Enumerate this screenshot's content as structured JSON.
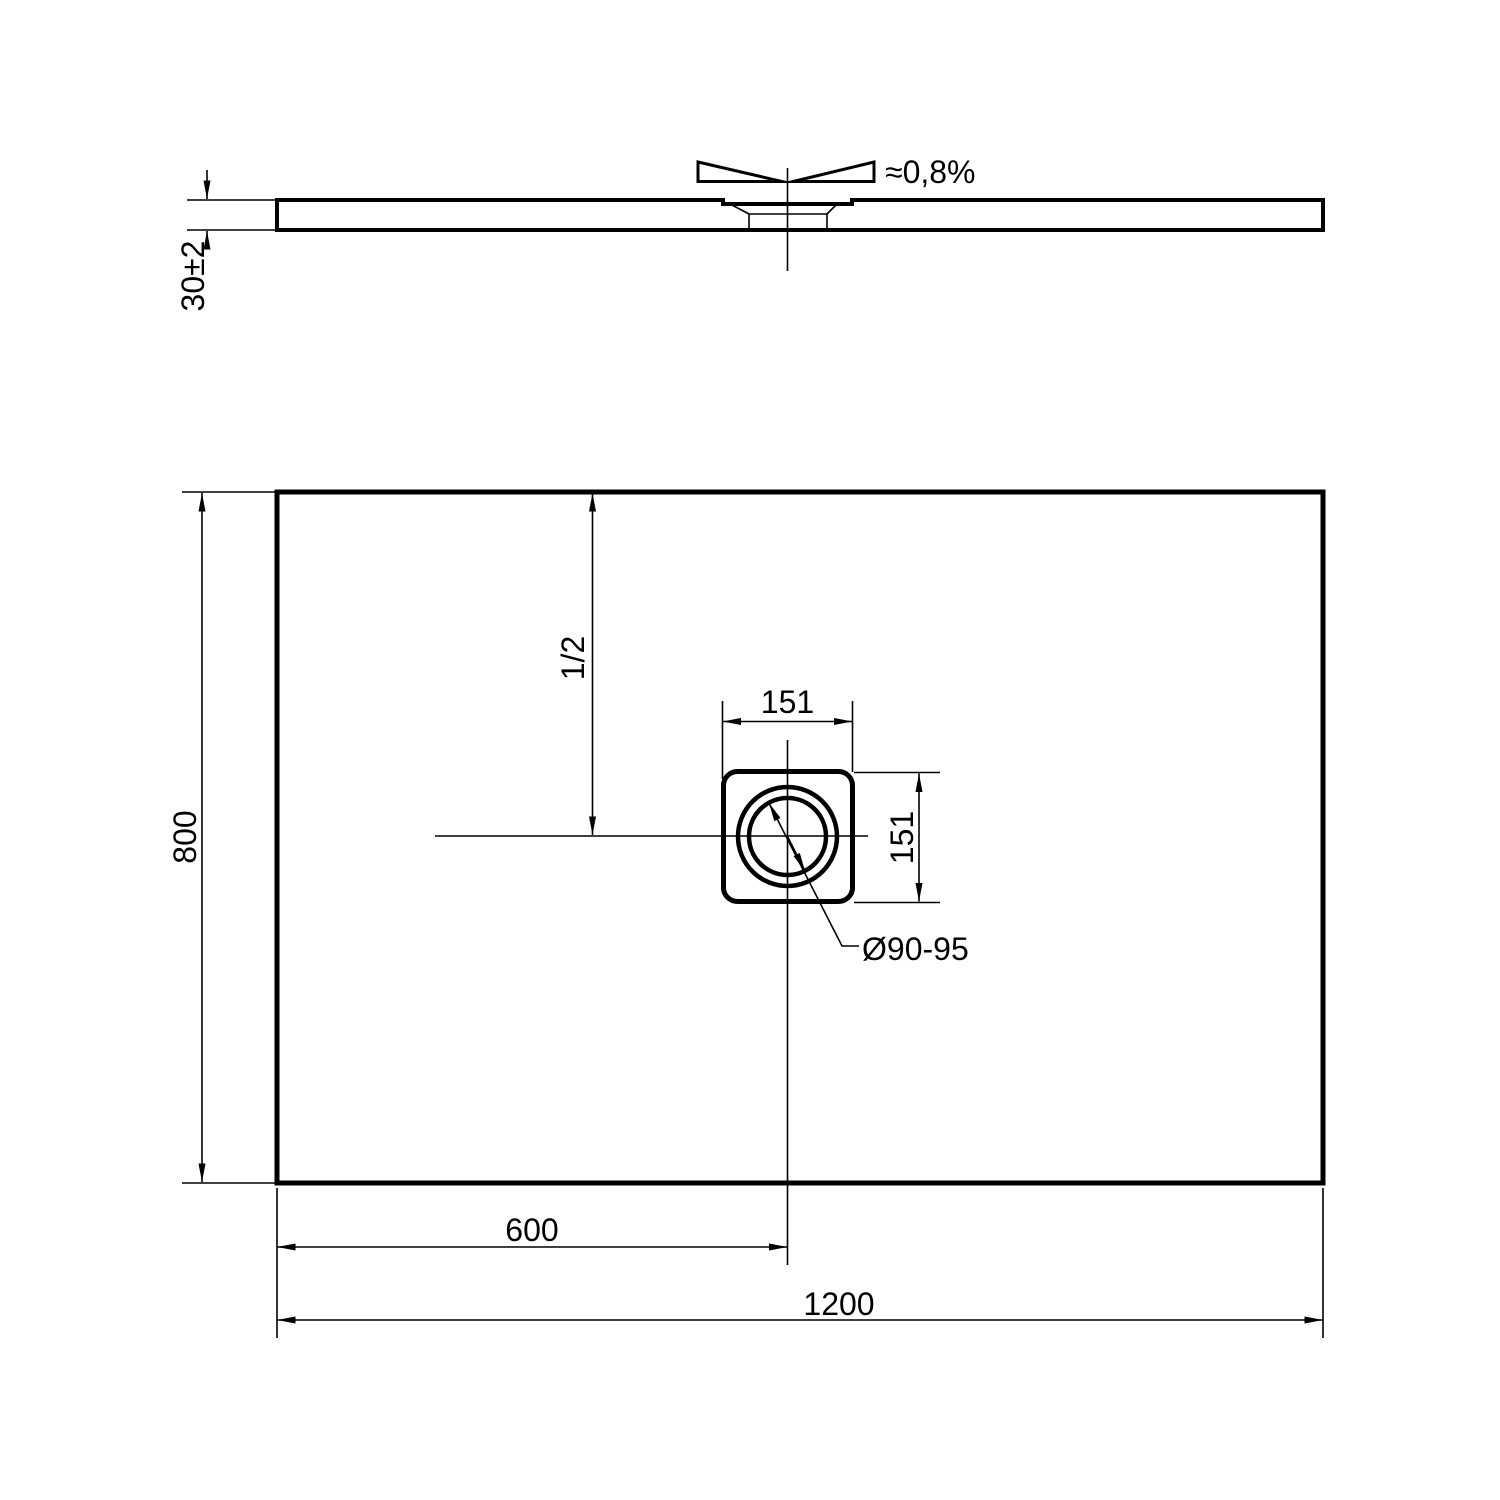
{
  "side_view": {
    "slope_label": "≈0,8%",
    "thickness_label": "30±2"
  },
  "plan_view": {
    "length_label": "1200",
    "width_label": "800",
    "drain_offset_label": "600",
    "half_depth_label": "1/2",
    "drain_box_width_label": "151",
    "drain_box_height_label": "151",
    "drain_hole_label": "Ø90-95"
  },
  "colors": {
    "line": "#000000",
    "background": "#ffffff"
  }
}
